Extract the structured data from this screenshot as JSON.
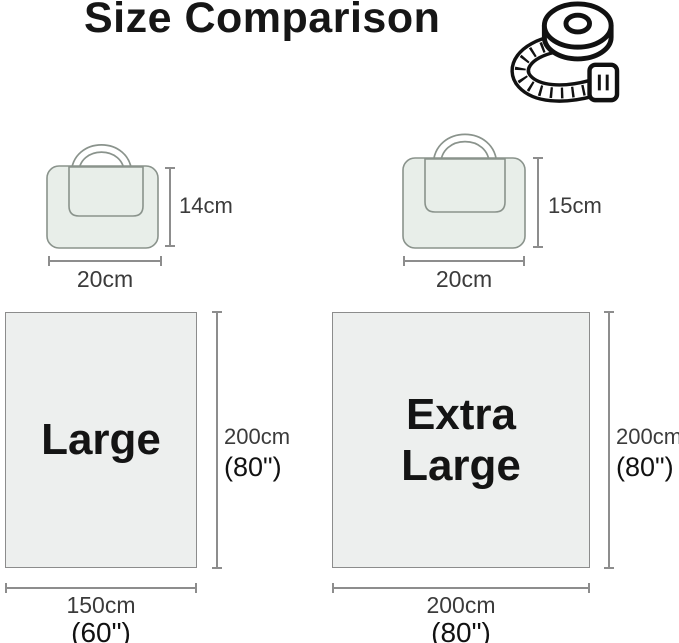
{
  "title": "Size Comparison",
  "header_icon": "measuring-tape",
  "bags": [
    {
      "name": "folded-bag-small",
      "height_label": "14cm",
      "width_label": "20cm"
    },
    {
      "name": "folded-bag-large",
      "height_label": "15cm",
      "width_label": "20cm"
    }
  ],
  "blankets": [
    {
      "name": "Large",
      "height_cm": "200cm",
      "height_in": "(80\")",
      "width_cm": "150cm",
      "width_in": "(60\")"
    },
    {
      "name": "Extra Large",
      "height_cm": "200cm",
      "height_in": "(80\")",
      "width_cm": "200cm",
      "width_in": "(80\")"
    }
  ],
  "colors": {
    "bag_fill": "#e8eee9",
    "bag_outline": "#8a938c",
    "blanket_fill": "#edefee",
    "blanket_outline": "#8c8c8c",
    "dimension_line": "#8d8d8d",
    "label_gray": "#3b3b3b",
    "label_black": "#111111",
    "title_color": "#161616"
  }
}
